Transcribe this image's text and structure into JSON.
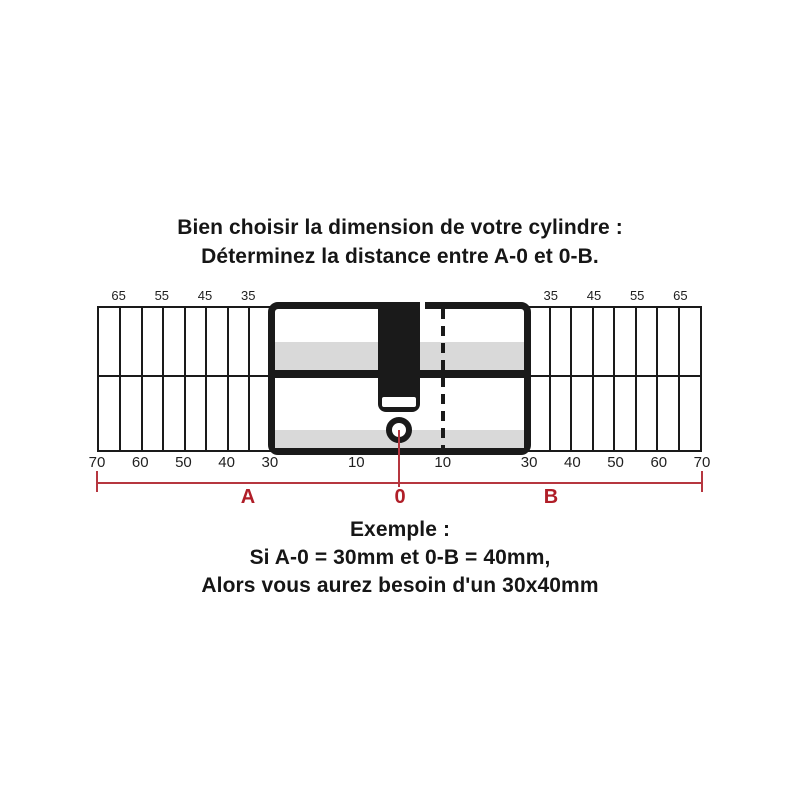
{
  "title": {
    "line1": "Bien choisir la dimension de votre cylindre :",
    "line2": "Déterminez la distance entre A-0 et 0-B."
  },
  "ruler": {
    "unit": "mm",
    "top_labels": [
      "65",
      "55",
      "45",
      "35",
      "35",
      "45",
      "55",
      "65"
    ],
    "bottom_labels": [
      "70",
      "60",
      "50",
      "40",
      "30",
      "10",
      "10",
      "30",
      "40",
      "50",
      "60",
      "70"
    ]
  },
  "dimension": {
    "a": "A",
    "zero": "0",
    "b": "B"
  },
  "example": {
    "line1": "Exemple :",
    "line2": "Si A-0 = 30mm et 0-B = 40mm,",
    "line3": "Alors vous aurez besoin d'un 30x40mm"
  },
  "colors": {
    "ink": "#1a1a1a",
    "band_gray": "#d9d9d9",
    "accent_red": "#b01e28",
    "line_red": "#b6363f"
  }
}
